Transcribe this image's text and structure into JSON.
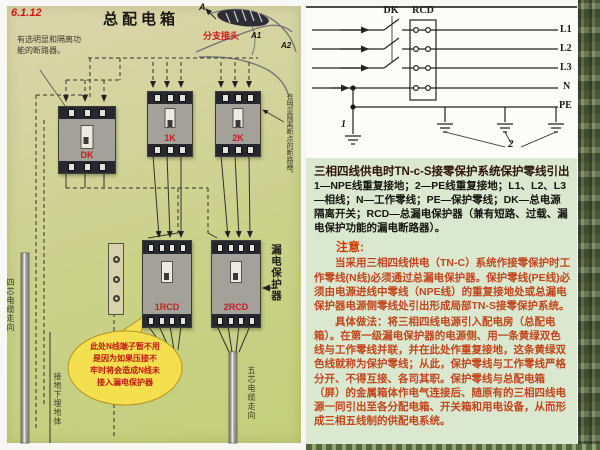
{
  "figure_number": "6.1.12",
  "colors": {
    "accent_red": "#c41f1f",
    "note_orange": "#c2451c",
    "callout_yellow": "#f4e04e",
    "text_panel_green": "#dbe8d0",
    "diagram_paper_green": "#cad28a"
  },
  "left_panel": {
    "title": "总配电箱",
    "top_note": "有选明显和隔离功\n能的断路器。",
    "point_a": "A",
    "point_a1": "A1",
    "point_a2": "A2",
    "branch_joint": "分支接头",
    "breaker_main_label": "DK",
    "breaker_1_label": "1K",
    "breaker_2_label": "2K",
    "rcd_1_label": "1RCD",
    "rcd_2_label": "2RCD",
    "rcd_side_label": "漏电保护器",
    "right_note": "有明显隔离断点的断路器。",
    "callout_text": "此处N线端子暂不用\n是因为如果压接不\n牢时将会造成N线未\n接入漏电保护器",
    "cable_4core": "四芯电缆走向",
    "cable_5core": "五芯电缆走向",
    "earth_note": "接地下埋地体"
  },
  "schematic": {
    "dk": "DK",
    "rcd": "RCD",
    "lines": [
      "L1",
      "L2",
      "L3",
      "N",
      "PE"
    ],
    "ground_1": "1",
    "ground_2": "2"
  },
  "caption": {
    "title": "三相四线供电时TN-c-S接零保护系统保护零线引出",
    "legend": "1—NPE线重复接地；2—PE线重复接地；L1、L2、L3—相线；N—工作零线；PE—保护零线；DK—总电源隔离开关；RCD—总漏电保护器（兼有短路、过载、漏电保护功能的漏电断路器）。"
  },
  "note": {
    "heading": "注意:",
    "para1": "当采用三相四线供电（TN-C）系统作接零保护时工作零线(N线)必须通过总漏电保护器。保护零线(PE线)必须由电源进线中零线（NPE线）的重复接地处或总漏电保护器电源侧零线处引出形成局部TN-S接零保护系统。",
    "para2": "具体做法：将三相四线电源引入配电房（总配电箱）。在第一级漏电保护器的电源侧、用一条黄绿双色线与工作零线并联，并在此处作重复接地，这条黄绿双色线就称为保护零线；从此，保护零线与工作零线严格分开、不得互接、各司其职。保护零线与总配电箱（屏）的金属箱体作电气连接后、随原有的三相四线电源一同引出至各分配电箱、开关箱和用电设备，从而形成三相五线制的供配电系统。"
  }
}
